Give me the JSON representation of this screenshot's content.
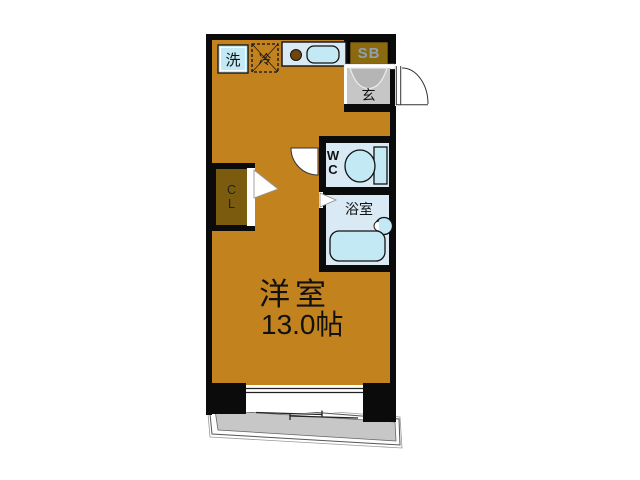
{
  "floorplan": {
    "rooms": {
      "main_room": {
        "name": "洋室",
        "size": "13.0帖"
      },
      "bathroom": {
        "label": "浴室"
      },
      "toilet": {
        "line1": "W",
        "line2": "C"
      },
      "entrance": {
        "label": "玄"
      },
      "shoe_box": {
        "label": "SB"
      },
      "closet": {
        "line1": "C",
        "line2": "L"
      },
      "washing_machine": {
        "label": "洗"
      },
      "refrigerator": {
        "label": "冷"
      }
    },
    "colors": {
      "wall": "#0b0b0b",
      "floor": "#c2821e",
      "fixture_panel": "#d9eaf5",
      "fixture_fill": "#c3e9f4",
      "cabinet": "#8a690f",
      "closet_fill": "#7b5c0e",
      "entrance_gray": "#c6c6c6",
      "balcony_gray": "#c7c7c7",
      "sb_text": "#8fa0b2",
      "burner": "#6f450c"
    }
  }
}
